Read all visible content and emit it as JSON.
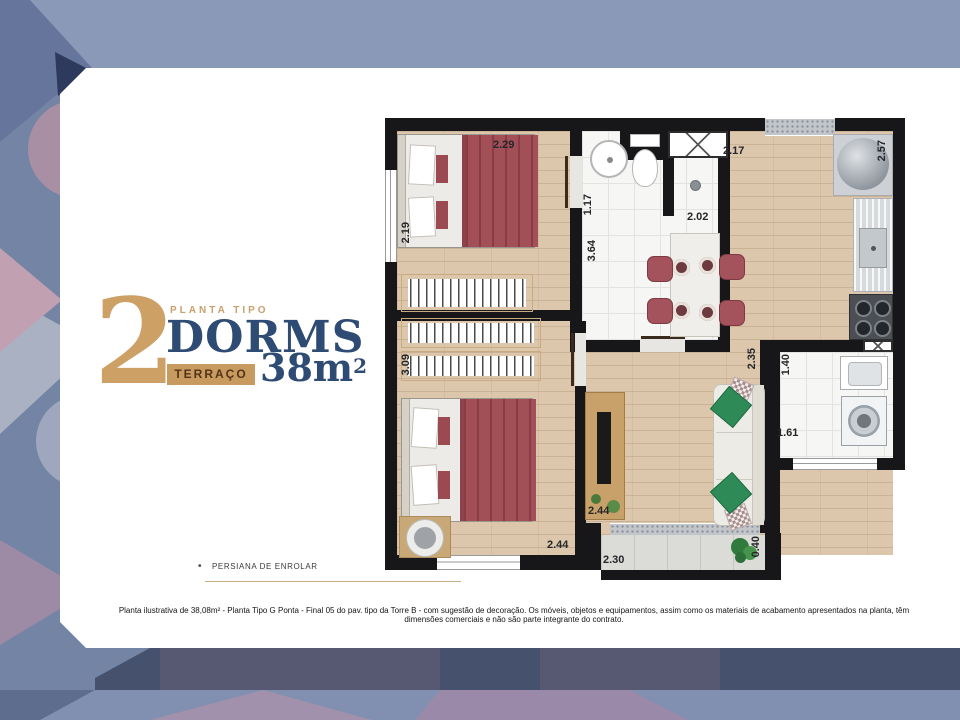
{
  "slide": {
    "title": {
      "number": "2",
      "kicker": "PLANTA TIPO",
      "name": "DORMS",
      "badge": "TERRAÇO",
      "area": "38m",
      "area_exponent": "2"
    },
    "legend": {
      "marker": "•",
      "label": "PERSIANA DE ENROLAR"
    },
    "disclaimer": "Planta ilustrativa de 38,08m² - Planta Tipo G Ponta - Final 05 do pav. tipo da Torre B - com sugestão de decoração. Os móveis, objetos e equipamentos, assim como os materiais de acabamento apresentados na planta, têm dimensões comerciais e não são parte integrante do contrato."
  },
  "floorplan": {
    "dimensions": [
      {
        "value": "2.29"
      },
      {
        "value": "1.17"
      },
      {
        "value": "2.02"
      },
      {
        "value": "2.17"
      },
      {
        "value": "2.57"
      },
      {
        "value": "2.19"
      },
      {
        "value": "3.64"
      },
      {
        "value": "3.09"
      },
      {
        "value": "2.35"
      },
      {
        "value": "1.40"
      },
      {
        "value": "1.61"
      },
      {
        "value": "2.44"
      },
      {
        "value": "2.44"
      },
      {
        "value": "2.30"
      },
      {
        "value": "0.40"
      }
    ]
  },
  "colors": {
    "accent_tan": "#CDA066",
    "navy": "#2E4B74",
    "wall": "#17171A",
    "wood_floor": "#DCC7AC",
    "bed_red": "#A24F58",
    "pillow_green": "#2E8B57",
    "background_base": "#7384A4",
    "bottom_band": "#46526D",
    "card": "#FFFFFF"
  }
}
